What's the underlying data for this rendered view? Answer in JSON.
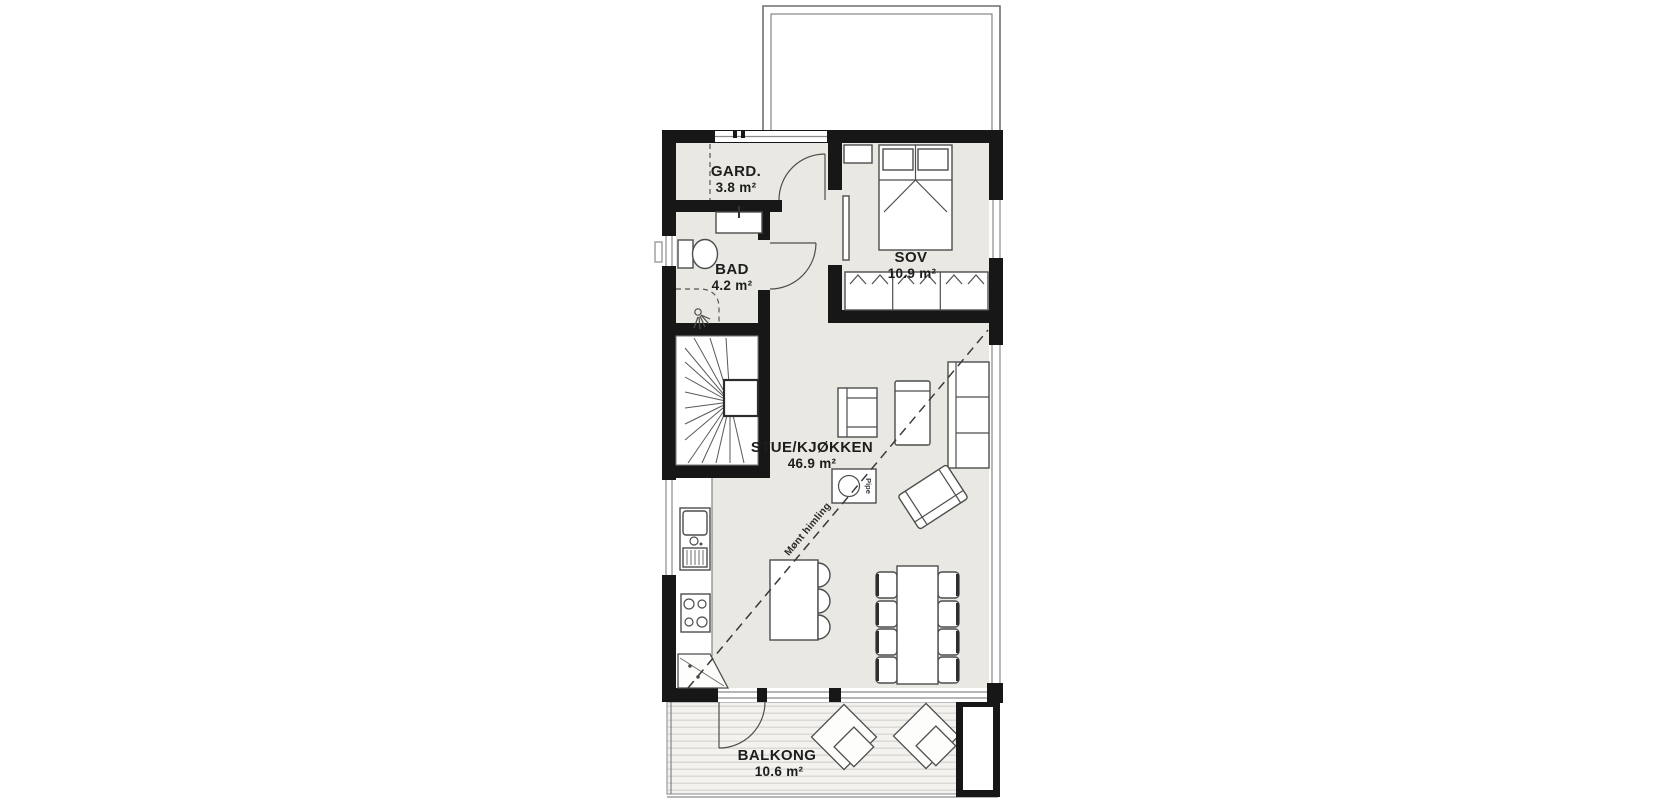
{
  "rooms": {
    "gard": {
      "name": "GARD.",
      "area": "3.8 m²"
    },
    "bad": {
      "name": "BAD",
      "area": "4.2 m²"
    },
    "sov": {
      "name": "SOV",
      "area": "10.9 m²"
    },
    "stue": {
      "name": "STUE/KJØKKEN",
      "area": "46.9 m²"
    },
    "balkong": {
      "name": "BALKONG",
      "area": "10.6 m²"
    }
  },
  "annotations": {
    "ceiling_line": "Mønt himling",
    "chimney": "Pipe"
  },
  "colors": {
    "wall": "#171717",
    "floor": "#e9e8e2",
    "background": "#ffffff",
    "line": "#4d4d4d"
  }
}
